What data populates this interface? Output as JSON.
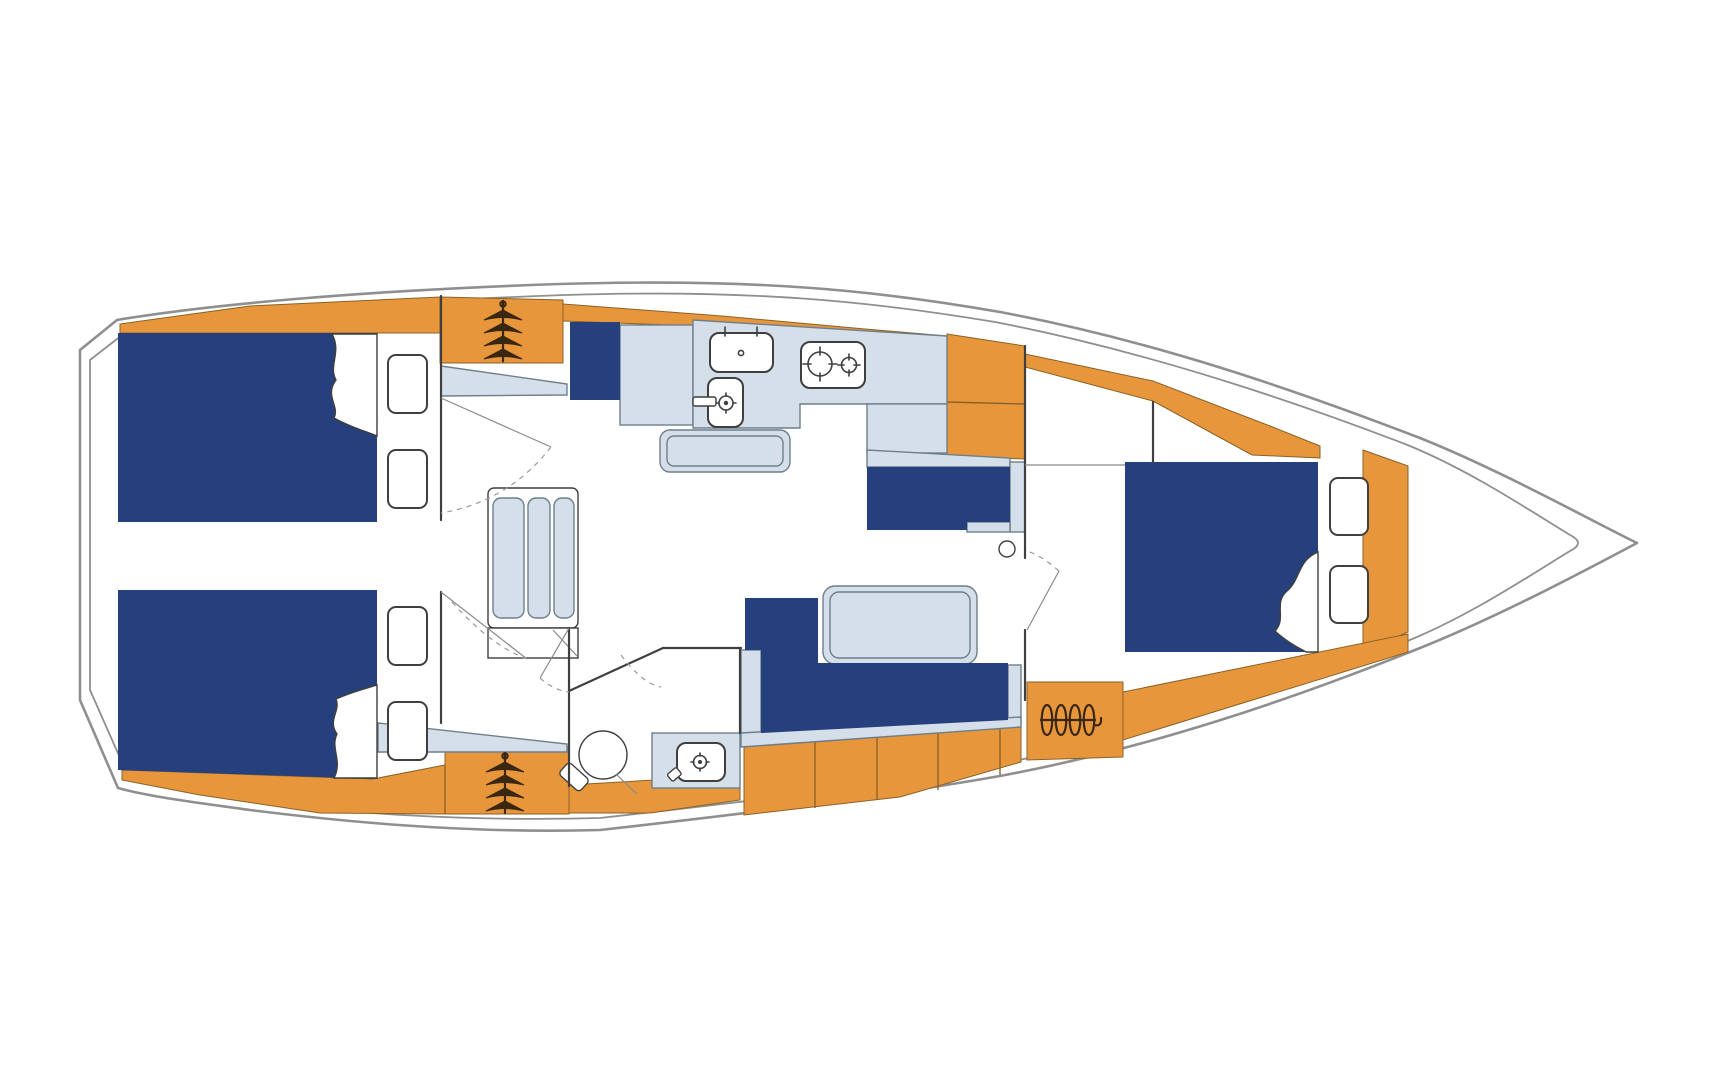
{
  "diagram": {
    "type": "boat-floor-plan",
    "description": "Top-down interior layout plan of a sailing yacht, bow pointing right",
    "rooms": [
      "aft-cabin-port",
      "aft-cabin-starboard",
      "salon",
      "galley",
      "head-with-washbasin",
      "forward-cabin"
    ],
    "fixtures": [
      "double-berth-aft-port",
      "double-berth-aft-starboard",
      "v-berth-forward",
      "wardrobe-port",
      "wardrobe-starboard",
      "wardrobe-forward",
      "companionway-steps",
      "galley-sink",
      "galley-washbasin",
      "galley-stove-two-burners",
      "salon-table",
      "l-shaped-settee",
      "nav-seat",
      "toilet",
      "vanity-washbasin",
      "storage-lockers",
      "bow-locker"
    ]
  },
  "colors": {
    "orange": "#E8963C",
    "orange_line": "#8a6228",
    "navy": "#25407D",
    "panel": "#D4DFE9",
    "panel_line": "#6d7f8c",
    "hull": "#8f8f8f",
    "wall": "#3f3f3f",
    "outline": "#3f3f3f",
    "hanger": "#3a2710",
    "background": "#ffffff"
  },
  "icons": [
    "hanger-icon",
    "stove-burner-icon",
    "faucet-icon",
    "toilet-icon",
    "sink-icon",
    "door-swing-arc",
    "pillow-fold",
    "cushion"
  ]
}
